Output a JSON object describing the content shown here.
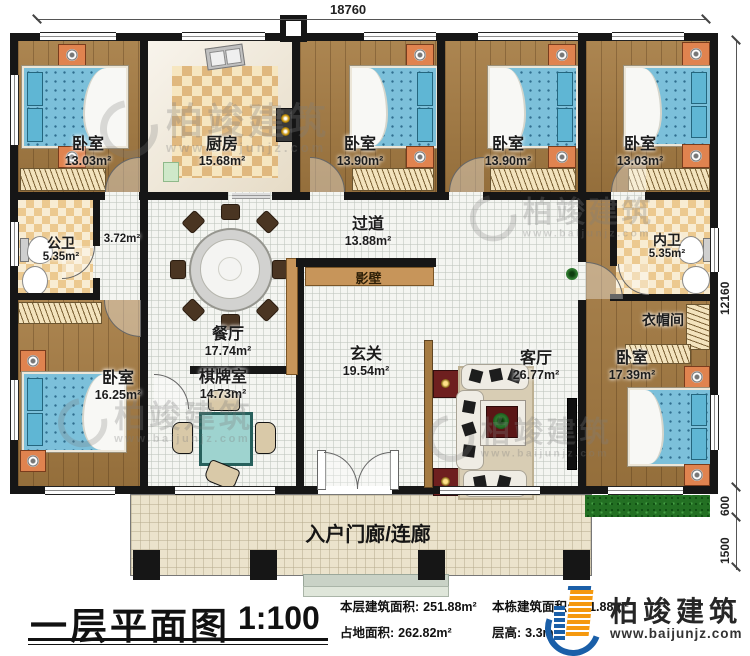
{
  "dimensions": {
    "top": "18760",
    "right_total": "12160",
    "right_grass": "600",
    "right_porch": "1500"
  },
  "rooms": [
    {
      "id": "bedroom-top-left",
      "name": "卧室",
      "area": "13.03m²"
    },
    {
      "id": "kitchen",
      "name": "厨房",
      "area": "15.68m²"
    },
    {
      "id": "bedroom-top-2",
      "name": "卧室",
      "area": "13.90m²"
    },
    {
      "id": "bedroom-top-3",
      "name": "卧室",
      "area": "13.90m²"
    },
    {
      "id": "bedroom-top-right",
      "name": "卧室",
      "area": "13.03m²"
    },
    {
      "id": "public-bath",
      "name": "公卫",
      "area": "5.35m²"
    },
    {
      "id": "hall",
      "name": "",
      "area": "3.72m²"
    },
    {
      "id": "corridor",
      "name": "过道",
      "area": "13.88m²"
    },
    {
      "id": "screen-wall",
      "name": "影壁",
      "area": ""
    },
    {
      "id": "inner-bath",
      "name": "内卫",
      "area": "5.35m²"
    },
    {
      "id": "dining",
      "name": "餐厅",
      "area": "17.74m²"
    },
    {
      "id": "foyer",
      "name": "玄关",
      "area": "19.54m²"
    },
    {
      "id": "living",
      "name": "客厅",
      "area": "26.77m²"
    },
    {
      "id": "cloakroom",
      "name": "衣帽间",
      "area": ""
    },
    {
      "id": "bedroom-bottom-right",
      "name": "卧室",
      "area": "17.39m²"
    },
    {
      "id": "bedroom-bottom-left",
      "name": "卧室",
      "area": "16.25m²"
    },
    {
      "id": "game-room",
      "name": "棋牌室",
      "area": "14.73m²"
    },
    {
      "id": "porch",
      "name": "入户门廊/连廊",
      "area": ""
    }
  ],
  "footer": {
    "title": "一层平面图",
    "scale": "1:100",
    "stats": [
      {
        "label": "本层建筑面积:",
        "value": "251.88m²"
      },
      {
        "label": "占地面积:",
        "value": "262.82m²"
      },
      {
        "label": "本栋建筑面积:",
        "value": "251.88m²"
      },
      {
        "label": "层高:",
        "value": "3.3m"
      }
    ],
    "brand": {
      "name": "柏竣建筑",
      "url": "www.baijunjz.com"
    }
  },
  "watermark": {
    "name": "柏竣建筑",
    "url": "www.baijunjz.com"
  },
  "colors": {
    "wall": "#161616",
    "wood": "#a57b42",
    "mattress": "#7cc0da",
    "brand_blue": "#1a5fa8",
    "brand_orange": "#f5990f",
    "grass": "#237023"
  }
}
